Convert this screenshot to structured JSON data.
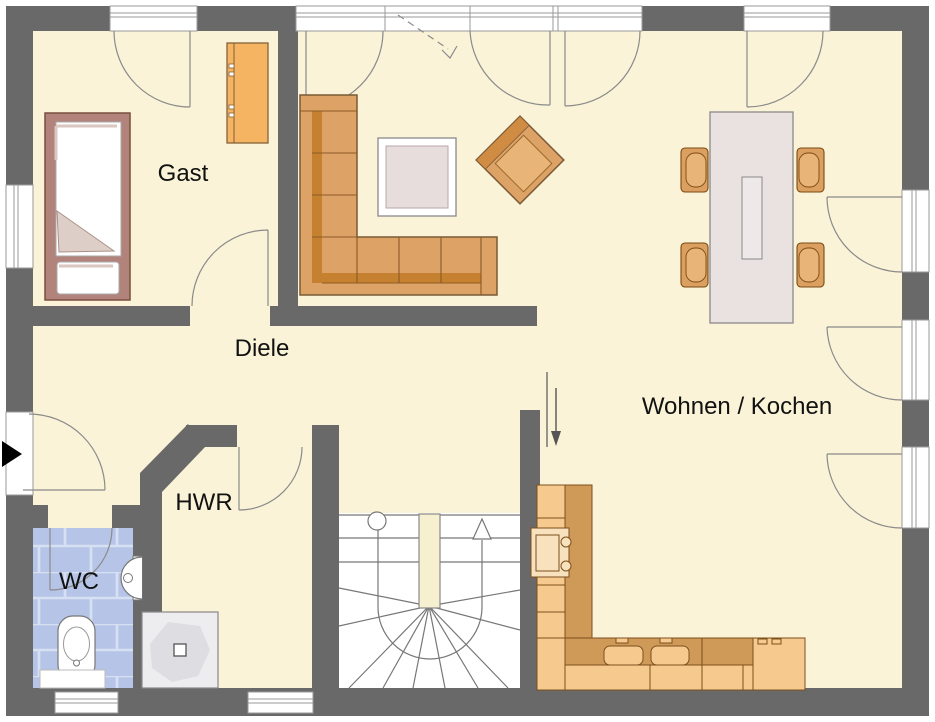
{
  "plan": {
    "title": "Erdgeschoss Grundriss",
    "labels": {
      "gast": "Gast",
      "diele": "Diele",
      "hwr": "HWR",
      "wc": "WC",
      "wohnen_kochen": "Wohnen / Kochen"
    },
    "colors": {
      "wall": "#696969",
      "floor": "#faf3d8",
      "tile_base": "#b6c5e7",
      "tile_grout": "#d7e0f3",
      "stair_floor": "#ffffff",
      "newel": "#f7f0d0",
      "sofa_wood": "#dda266",
      "sofa_shadow": "#c5812f",
      "chair_wood": "#db9f5f",
      "chair_seat": "#e8b478",
      "counter_light": "#f6c98e",
      "counter_dark": "#cf9a58",
      "appliance": "#f8e2bd",
      "table_top": "#eae1e1",
      "bed_frame": "#b2837a",
      "blanket": "#ddcfc8",
      "wardrobe": "#f4b462",
      "shower_pan": "#ededef",
      "shower_blob": "#dedee2",
      "fixture_white": "#ffffff",
      "outline_dark": "#7a5a35",
      "label_text": "#111111"
    }
  }
}
